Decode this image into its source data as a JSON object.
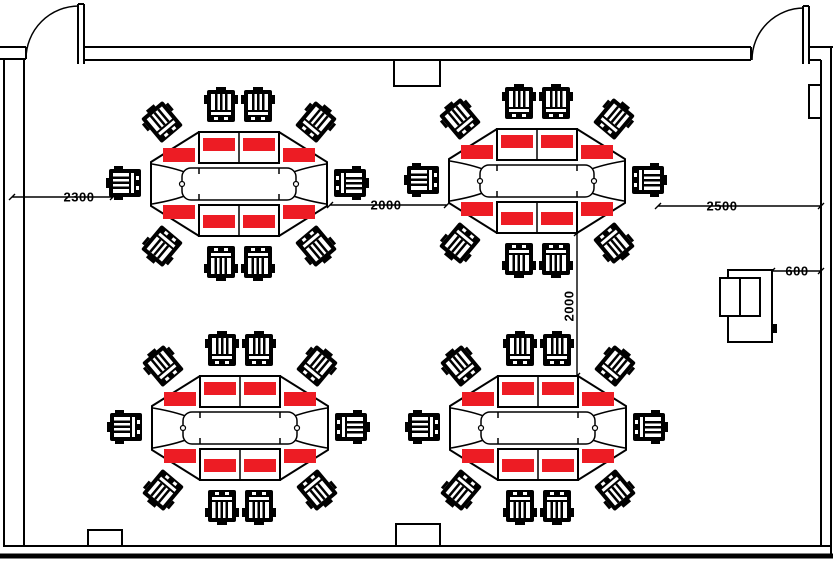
{
  "drawing": {
    "type": "meeting-room floor plan",
    "doors": 2,
    "wall_columns": 3,
    "wall_panel_right": 1
  },
  "dimensions": {
    "left": {
      "label": "2300",
      "orientation": "horizontal"
    },
    "between": {
      "label": "2000",
      "orientation": "horizontal"
    },
    "right": {
      "label": "2500",
      "orientation": "horizontal"
    },
    "cabinet": {
      "label": "600",
      "orientation": "horizontal"
    },
    "aisle": {
      "label": "2000",
      "orientation": "vertical"
    }
  },
  "tables": [
    {
      "id": 1,
      "position": "top-left",
      "chairs": 10,
      "place_mats": 8
    },
    {
      "id": 2,
      "position": "top-right",
      "chairs": 10,
      "place_mats": 8
    },
    {
      "id": 3,
      "position": "bottom-left",
      "chairs": 10,
      "place_mats": 8
    },
    {
      "id": 4,
      "position": "bottom-right",
      "chairs": 10,
      "place_mats": 8
    }
  ],
  "colors": {
    "mat_red": "#ED1C24",
    "line_black": "#000000",
    "background": "#FFFFFF"
  },
  "icons": {
    "chair": "top-view striped office chair square",
    "door": "quarter-circle swing arc with leaf",
    "place_mat": "solid red rectangle",
    "cabinet": "double-door cabinet top view"
  }
}
